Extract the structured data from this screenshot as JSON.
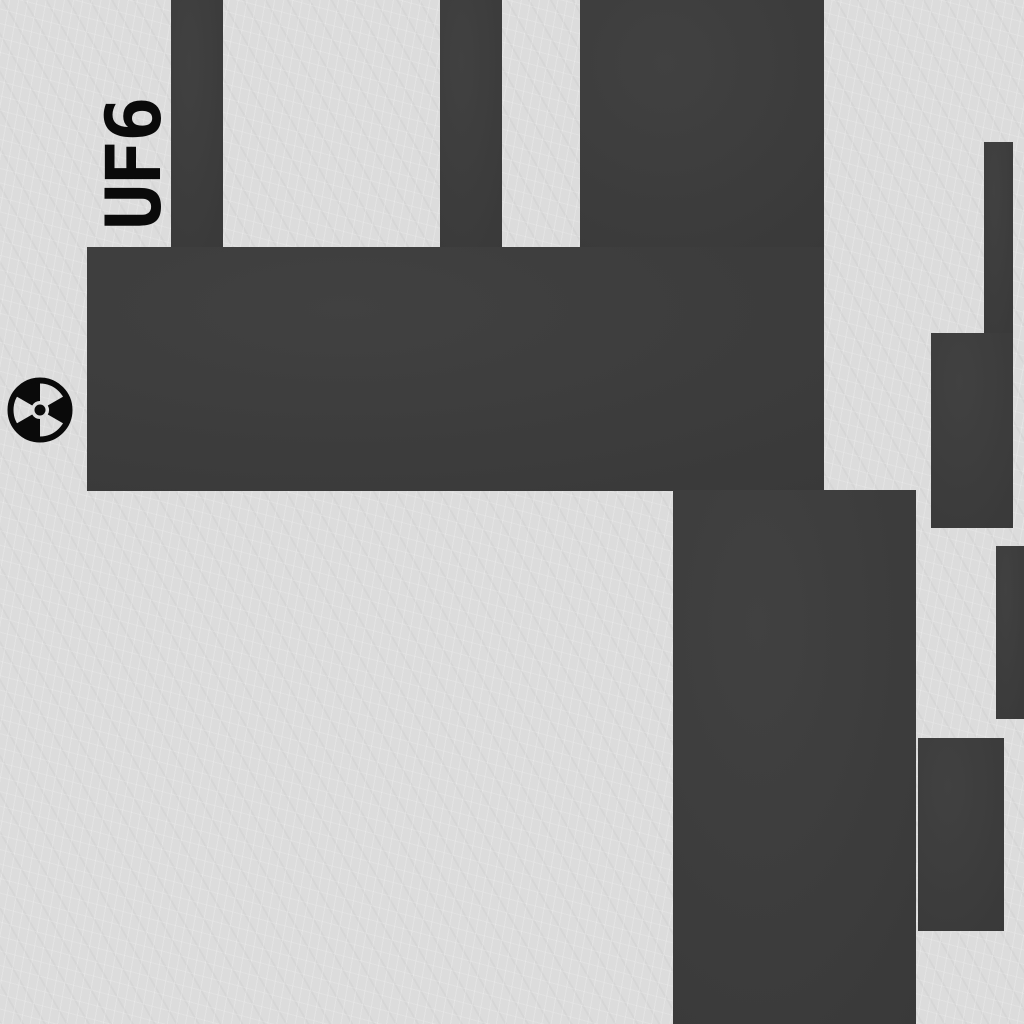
{
  "scene": {
    "type": "facility-map-texture",
    "label": {
      "text": "UF6",
      "rotation_deg": -90
    },
    "marker": {
      "icon": "radiation-trefoil-icon",
      "cx": 40,
      "cy": 410,
      "outer_radius": 33
    }
  },
  "colors": {
    "background_light": "#dcdcdc",
    "block_dark": "#3a3a3a",
    "ink_black": "#0a0a0a"
  },
  "blocks": [
    {
      "name": "top-strip-left",
      "x": 171,
      "y": 0,
      "w": 52,
      "h": 247
    },
    {
      "name": "top-strip-middle",
      "x": 440,
      "y": 0,
      "w": 62,
      "h": 247
    },
    {
      "name": "top-block",
      "x": 580,
      "y": 0,
      "w": 244,
      "h": 250
    },
    {
      "name": "horizontal-band",
      "x": 87,
      "y": 247,
      "w": 737,
      "h": 244
    },
    {
      "name": "lower-column",
      "x": 673,
      "y": 490,
      "w": 243,
      "h": 534
    },
    {
      "name": "right-strip",
      "x": 984,
      "y": 142,
      "w": 29,
      "h": 193
    },
    {
      "name": "right-block-upper",
      "x": 931,
      "y": 333,
      "w": 82,
      "h": 195
    },
    {
      "name": "right-edge-block",
      "x": 996,
      "y": 546,
      "w": 28,
      "h": 173
    },
    {
      "name": "right-block-lower",
      "x": 918,
      "y": 738,
      "w": 86,
      "h": 193
    }
  ]
}
